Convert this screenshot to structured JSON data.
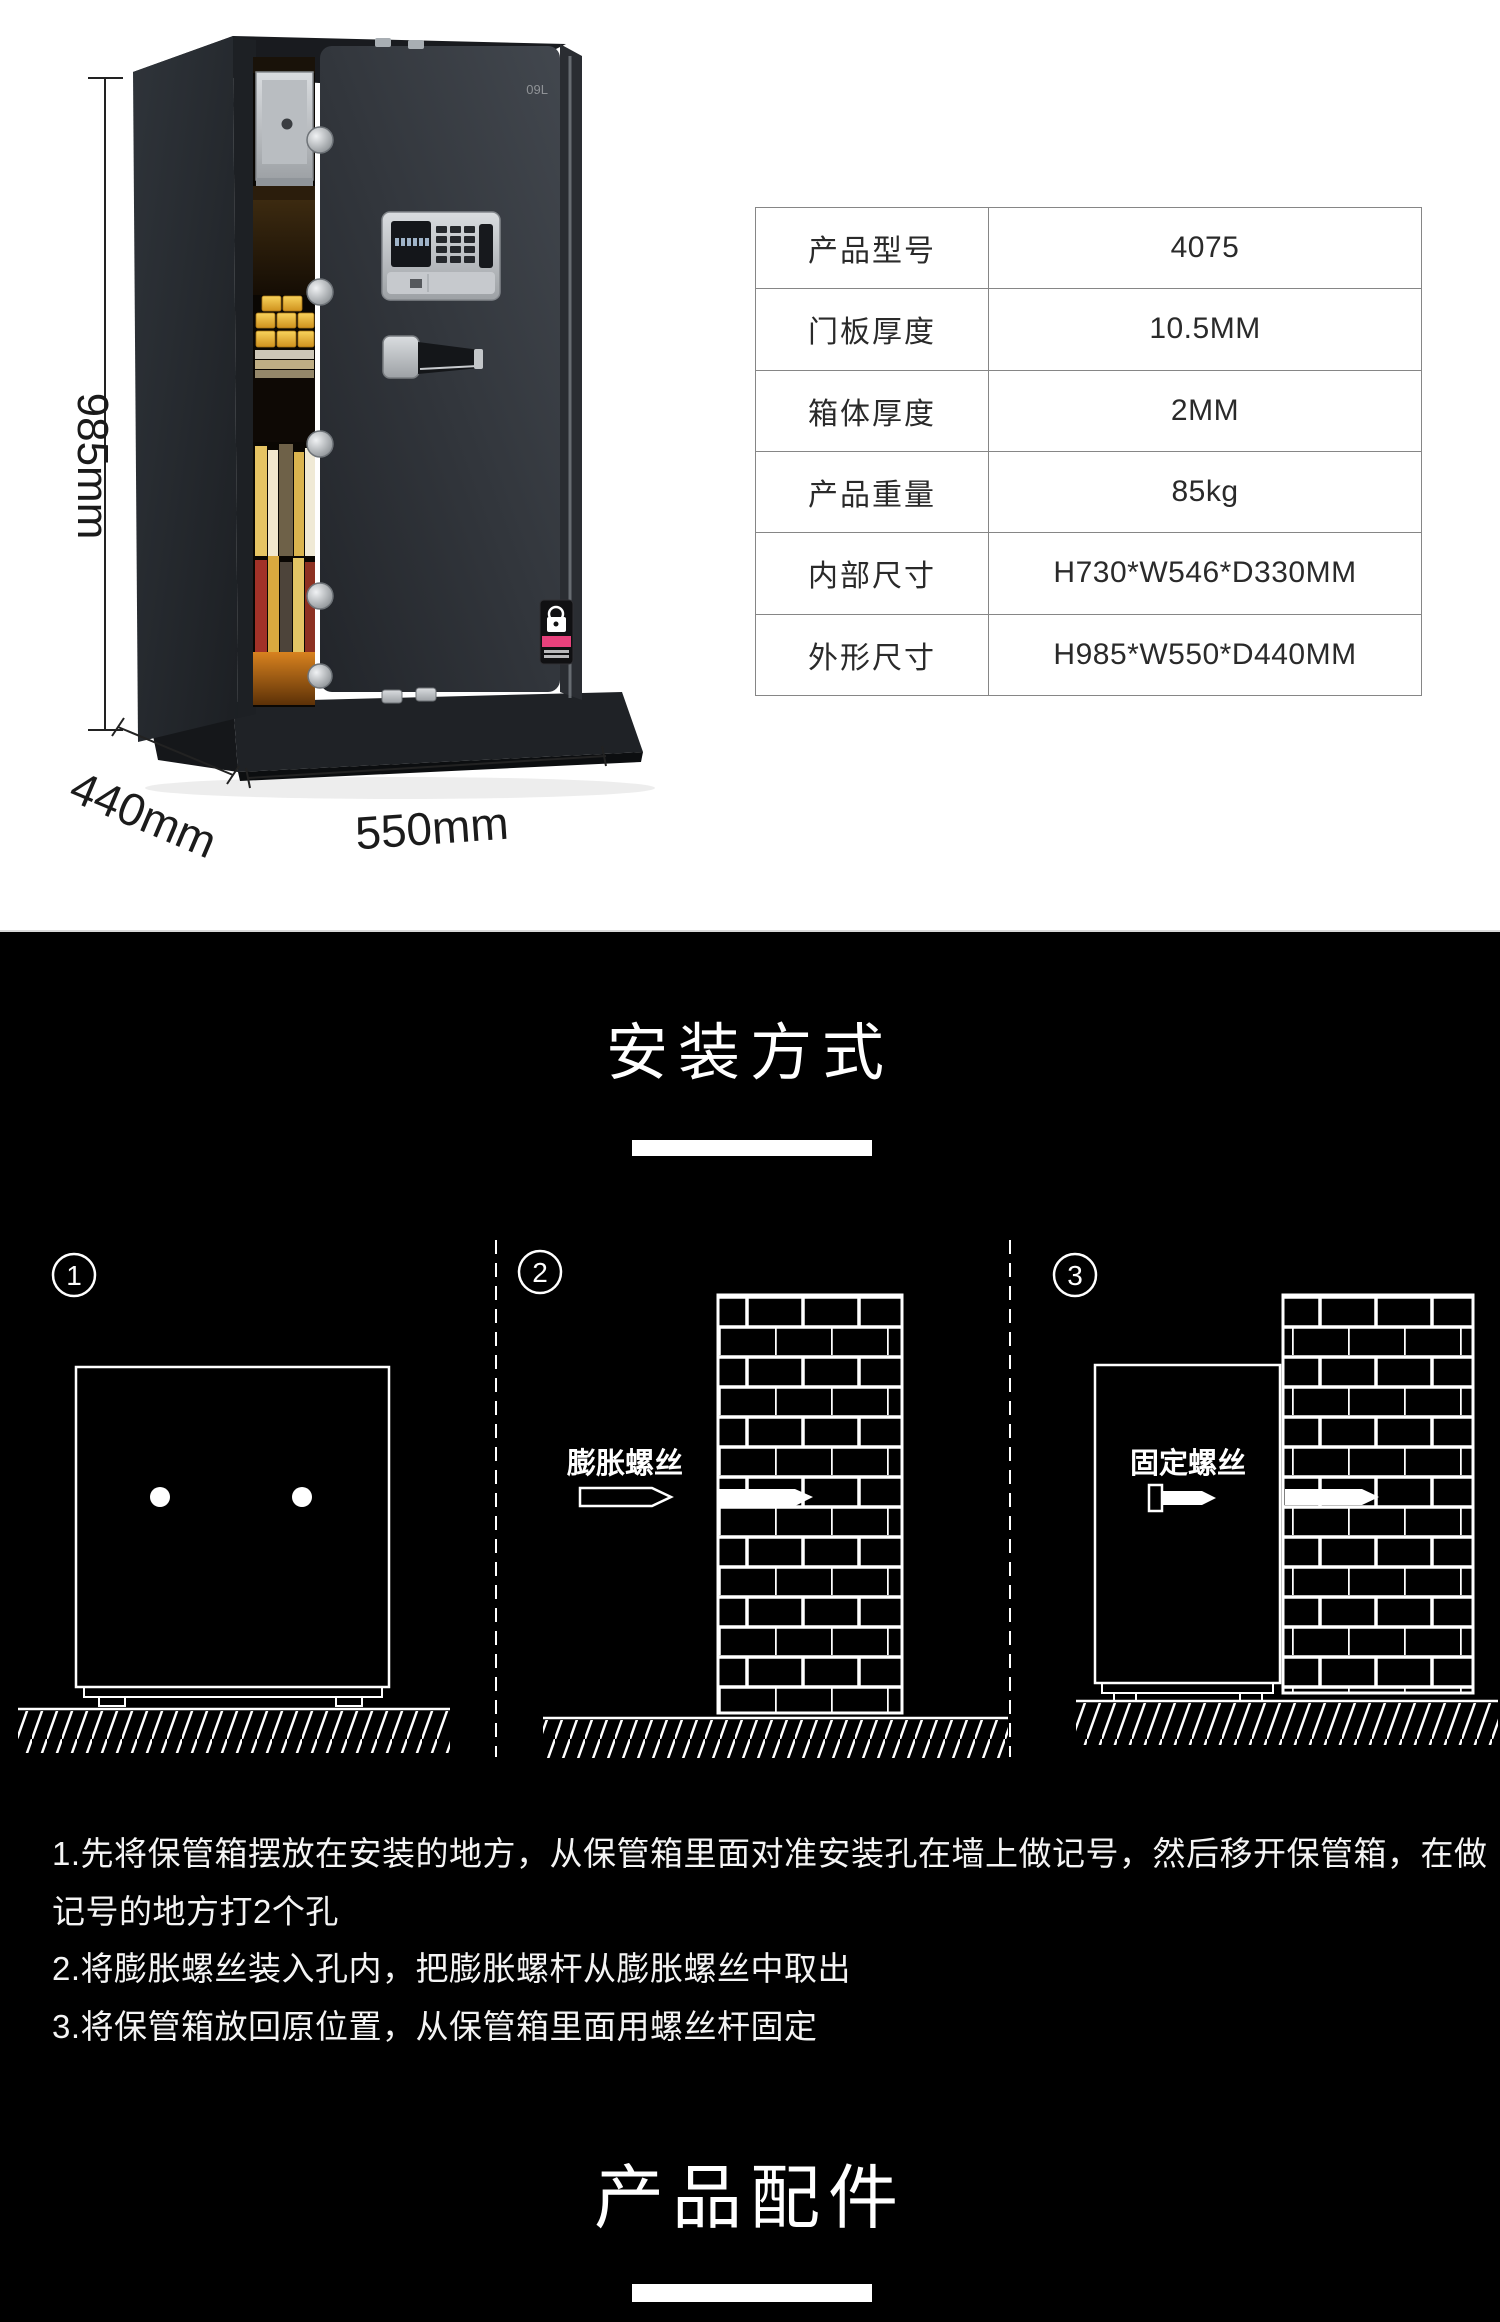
{
  "product": {
    "brand_mark": "09L"
  },
  "dimensions": {
    "height": "985mm",
    "depth": "440mm",
    "width": "550mm"
  },
  "spec_table": {
    "rows": [
      {
        "label": "产品型号",
        "value": "4075"
      },
      {
        "label": "门板厚度",
        "value": "10.5MM"
      },
      {
        "label": "箱体厚度",
        "value": "2MM"
      },
      {
        "label": "产品重量",
        "value": "85kg"
      },
      {
        "label": "内部尺寸",
        "value": "H730*W546*D330MM"
      },
      {
        "label": "外形尺寸",
        "value": "H985*W550*D440MM"
      }
    ]
  },
  "install_section": {
    "title": "安装方式",
    "diagrams": [
      {
        "num": "1"
      },
      {
        "num": "2",
        "screw_label": "膨胀螺丝"
      },
      {
        "num": "3",
        "screw_label": "固定螺丝"
      }
    ],
    "instructions": [
      "1.先将保管箱摆放在安装的地方，从保管箱里面对准安装孔在墙上做记号，然后移开保管箱，在做",
      "记号的地方打2个孔",
      "2.将膨胀螺丝装入孔内，把膨胀螺杆从膨胀螺丝中取出",
      "3.将保管箱放回原位置，从保管箱里面用螺丝杆固定"
    ]
  },
  "accessories_section": {
    "title": "产品配件"
  },
  "colors": {
    "page_bg": "#ffffff",
    "section_bg": "#000000",
    "table_border": "#878787",
    "diagram_stroke": "#ffffff",
    "sticker_accent_pink": "#e8417c",
    "gold": "#eab53d"
  }
}
